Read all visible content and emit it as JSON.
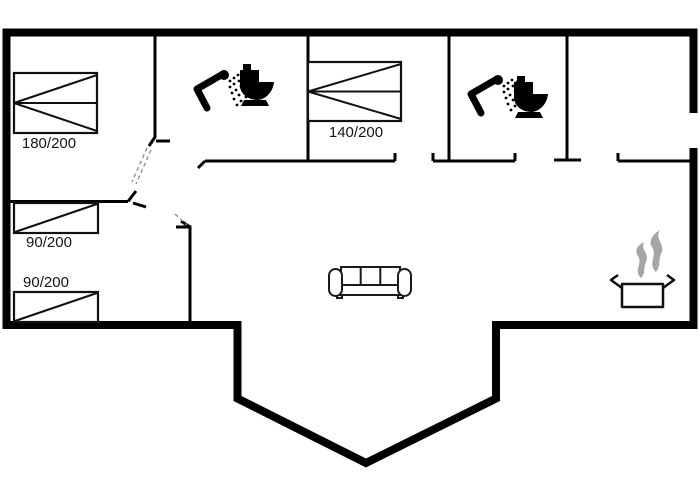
{
  "floorplan": {
    "bed_labels": {
      "double_bed_large": "180/200",
      "double_bed_medium": "140/200",
      "single_bed_upper": "90/200",
      "single_bed_lower": "90/200"
    },
    "colors": {
      "background": "#ffffff",
      "walls": "#000000",
      "furniture_outline": "#1a1a1a",
      "steam": "#a6a6a6",
      "label_text": "#151515"
    },
    "icons": [
      "shower-icon",
      "toilet-icon",
      "double-bed-icon",
      "single-bed-icon",
      "sofa-icon",
      "cooking-pot-icon",
      "steam-icon",
      "door-swing-dashed"
    ]
  }
}
